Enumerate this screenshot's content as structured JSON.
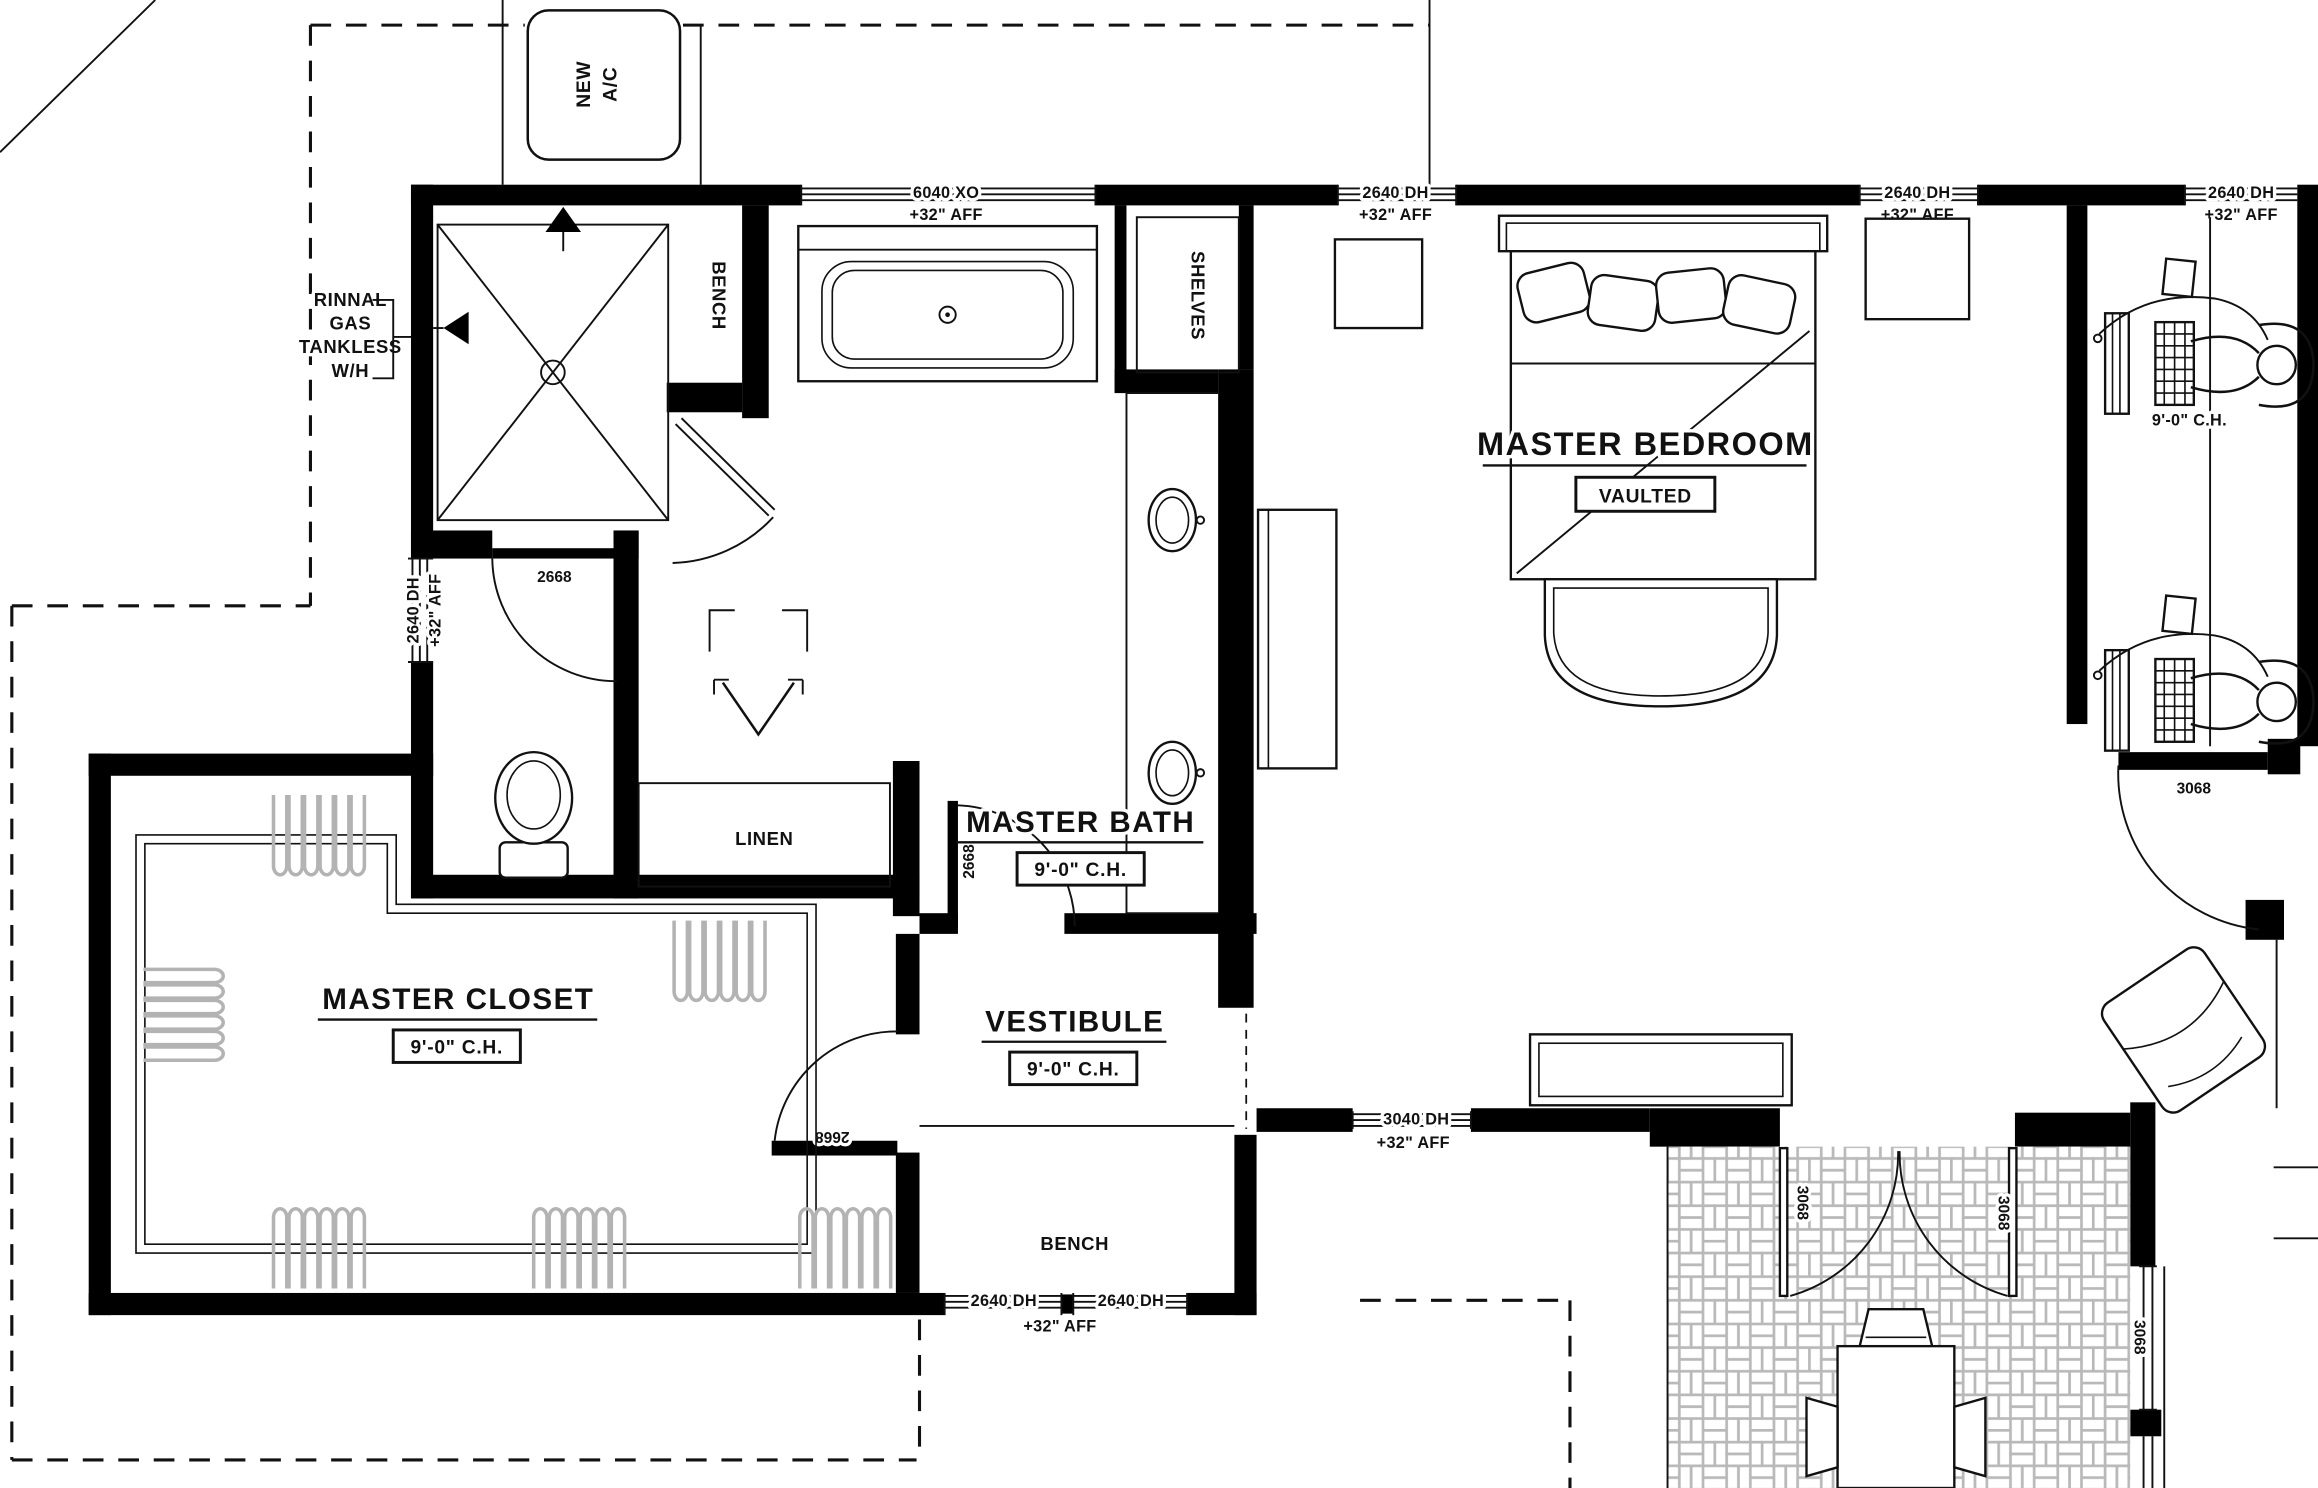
{
  "labels": {
    "ac": {
      "line1": "NEW",
      "line2": "A/C"
    },
    "water_heater": {
      "line1": "RINNAL",
      "line2": "GAS",
      "line3": "TANKLESS",
      "line4": "W/H"
    },
    "rooms": {
      "master_bedroom": {
        "name": "MASTER BEDROOM",
        "note": "VAULTED"
      },
      "master_bath": {
        "name": "MASTER BATH",
        "ceiling": "9'-0\" C.H."
      },
      "master_closet": {
        "name": "MASTER CLOSET",
        "ceiling": "9'-0\" C.H."
      },
      "vestibule": {
        "name": "VESTIBULE",
        "ceiling": "9'-0\" C.H."
      },
      "office": {
        "ceiling": "9'-0\" C.H."
      }
    },
    "fixtures": {
      "shower_bench": "BENCH",
      "shelves": "SHELVES",
      "linen": "LINEN",
      "entry_bench": "BENCH"
    },
    "windows": {
      "w6040": {
        "size": "6040 XO",
        "mount": "+32\" AFF"
      },
      "w2640": {
        "size": "2640 DH",
        "mount": "+32\" AFF"
      },
      "w3040": {
        "size": "3040 DH",
        "mount": "+32\" AFF"
      }
    },
    "doors": {
      "d2668": "2668",
      "d3068": "3068"
    }
  }
}
